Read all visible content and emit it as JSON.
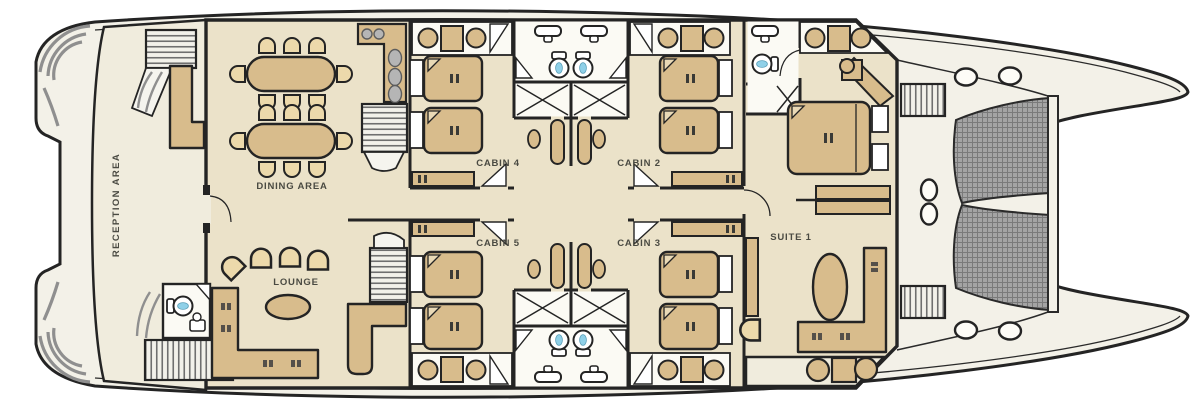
{
  "meta": {
    "title": "Catamaran main deck floor plan"
  },
  "palette": {
    "hull": "#f3f1e8",
    "floor": "#ebe2c9",
    "reception_floor": "#f0ecdd",
    "white_room": "#fbfaf4",
    "furniture": "#d8bc8c",
    "furniture_light": "#ecd9ab",
    "wall": "#242424",
    "stairs_stripe": "#6f6f6f",
    "mesh": "#a8a8a8",
    "water_accent": "#8fd0e8",
    "label": "#4a4a42"
  },
  "plan": {
    "rooms": [
      {
        "id": "reception",
        "label": "RECEPTION AREA"
      },
      {
        "id": "dining",
        "label": "DINING AREA"
      },
      {
        "id": "lounge",
        "label": "LOUNGE"
      },
      {
        "id": "cabin4",
        "label": "CABIN 4"
      },
      {
        "id": "cabin2",
        "label": "CABIN 2"
      },
      {
        "id": "cabin5",
        "label": "CABIN 5"
      },
      {
        "id": "cabin3",
        "label": "CABIN 3"
      },
      {
        "id": "suite1",
        "label": "SUITE 1"
      }
    ]
  }
}
